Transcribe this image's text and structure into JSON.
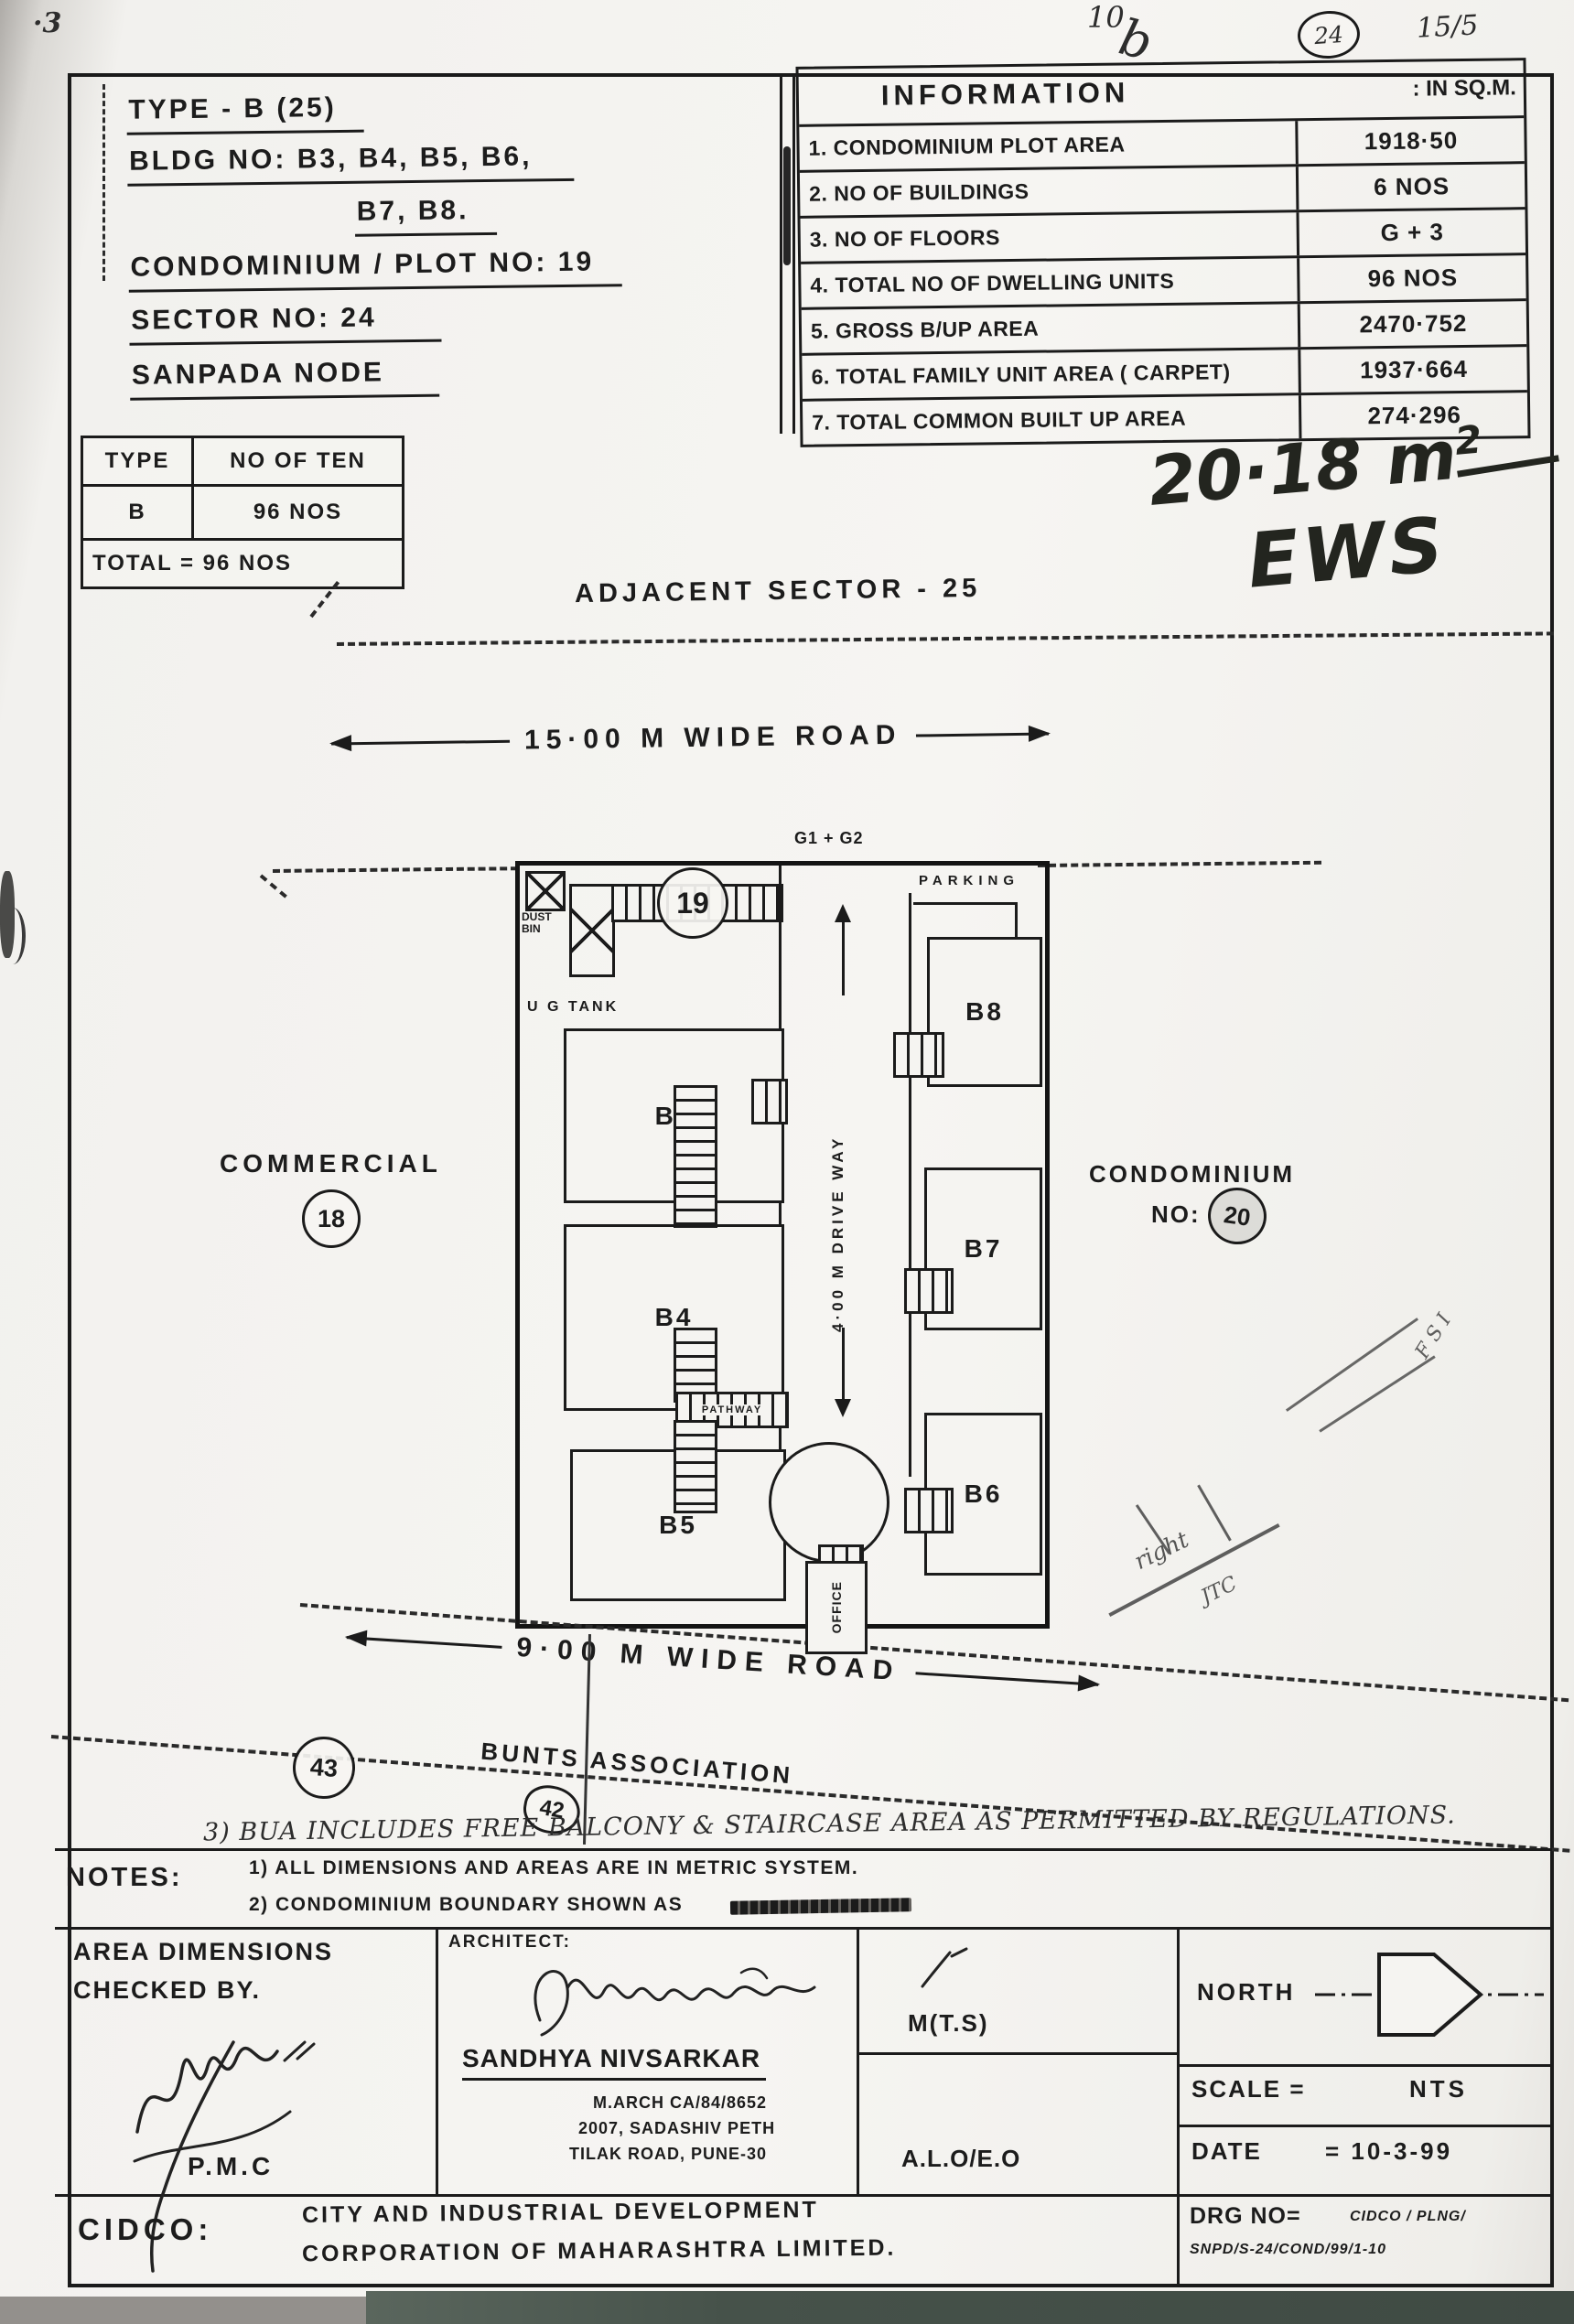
{
  "annotations": {
    "corner_mark": "·3",
    "top_mark": "10",
    "top_mark_b": "b",
    "top_circle": "24",
    "top_date": "15/5",
    "area_value": "20·18 m",
    "area_sup": "2",
    "area_label": "EWS",
    "scribble_fsi": "F S I",
    "scribble_right": "right",
    "scribble_jtc": "JTC",
    "note3": "3) BUA INCLUDES FREE BALCONY & STAIRCASE AREA AS PERMITTED BY REGULATIONS."
  },
  "title_block": {
    "line1": "TYPE - B (25)",
    "line2": "BLDG NO: B3, B4, B5, B6,",
    "line3": "B7, B8.",
    "line4": "CONDOMINIUM / PLOT NO: 19",
    "line5": "SECTOR NO: 24",
    "line6": "SANPADA NODE"
  },
  "information_table": {
    "title": "INFORMATION",
    "unit": ": IN SQ.M.",
    "rows": [
      {
        "label": "1. CONDOMINIUM PLOT AREA",
        "value": "1918·50"
      },
      {
        "label": "2. NO OF BUILDINGS",
        "value": "6 NOS"
      },
      {
        "label": "3. NO OF FLOORS",
        "value": "G + 3"
      },
      {
        "label": "4. TOTAL NO OF DWELLING UNITS",
        "value": "96 NOS"
      },
      {
        "label": "5. GROSS B/UP AREA",
        "value": "2470·752"
      },
      {
        "label": "6. TOTAL FAMILY UNIT AREA ( CARPET)",
        "value": "1937·664"
      },
      {
        "label": "7. TOTAL COMMON BUILT UP AREA",
        "value": "274·296"
      }
    ]
  },
  "type_table": {
    "col1": "TYPE",
    "col2": "NO OF TEN",
    "row_type": "B",
    "row_count": "96 NOS",
    "total": "TOTAL = 96 NOS"
  },
  "site_plan": {
    "adjacent_sector": "ADJACENT SECTOR - 25",
    "road_top": "15·00 M WIDE ROAD",
    "g_label": "G1 + G2",
    "parking": "PARKING",
    "dust_bin": "DUST BIN",
    "ug_tank": "U G TANK",
    "plot_circle": "19",
    "driveway": "4·00 M DRIVE WAY",
    "pathway": "PATHWAY",
    "office": "OFFICE",
    "b3": "B3",
    "b4": "B4",
    "b5": "B5",
    "b6": "B6",
    "b7": "B7",
    "b8": "B8",
    "commercial": "COMMERCIAL",
    "commercial_circle": "18",
    "condo_line1": "CONDOMINIUM",
    "condo_no": "NO:",
    "condo_circle": "20",
    "road_bottom": "9·00 M WIDE ROAD",
    "circle_43": "43",
    "bunts": "BUNTS ASSOCIATION",
    "circle_42": "42"
  },
  "notes": {
    "label": "NOTES:",
    "note1": "1) ALL DIMENSIONS AND AREAS ARE IN METRIC SYSTEM.",
    "note2": "2) CONDOMINIUM BOUNDARY SHOWN AS"
  },
  "footer": {
    "checked1": "AREA DIMENSIONS",
    "checked2": "CHECKED BY.",
    "pmc": "P.M.C",
    "architect_label": "ARCHITECT:",
    "architect_name": "SANDHYA NIVSARKAR",
    "architect_reg": "M.ARCH CA/84/8652",
    "architect_addr1": "2007, SADASHIV PETH",
    "architect_addr2": "TILAK ROAD, PUNE-30",
    "mts": "M(T.S)",
    "alo": "A.L.O/E.O",
    "north": "NORTH",
    "scale_label": "SCALE =",
    "scale_value": "NTS",
    "date_label": "DATE",
    "date_value": "= 10-3-99",
    "cidco": "CIDCO:",
    "cidco_line1": "CITY AND INDUSTRIAL DEVELOPMENT",
    "cidco_line2": "CORPORATION OF MAHARASHTRA LIMITED.",
    "drg_label": "DRG NO=",
    "drg_value1": "CIDCO / PLNG/",
    "drg_value2": "SNPD/S-24/COND/99/1-10"
  }
}
